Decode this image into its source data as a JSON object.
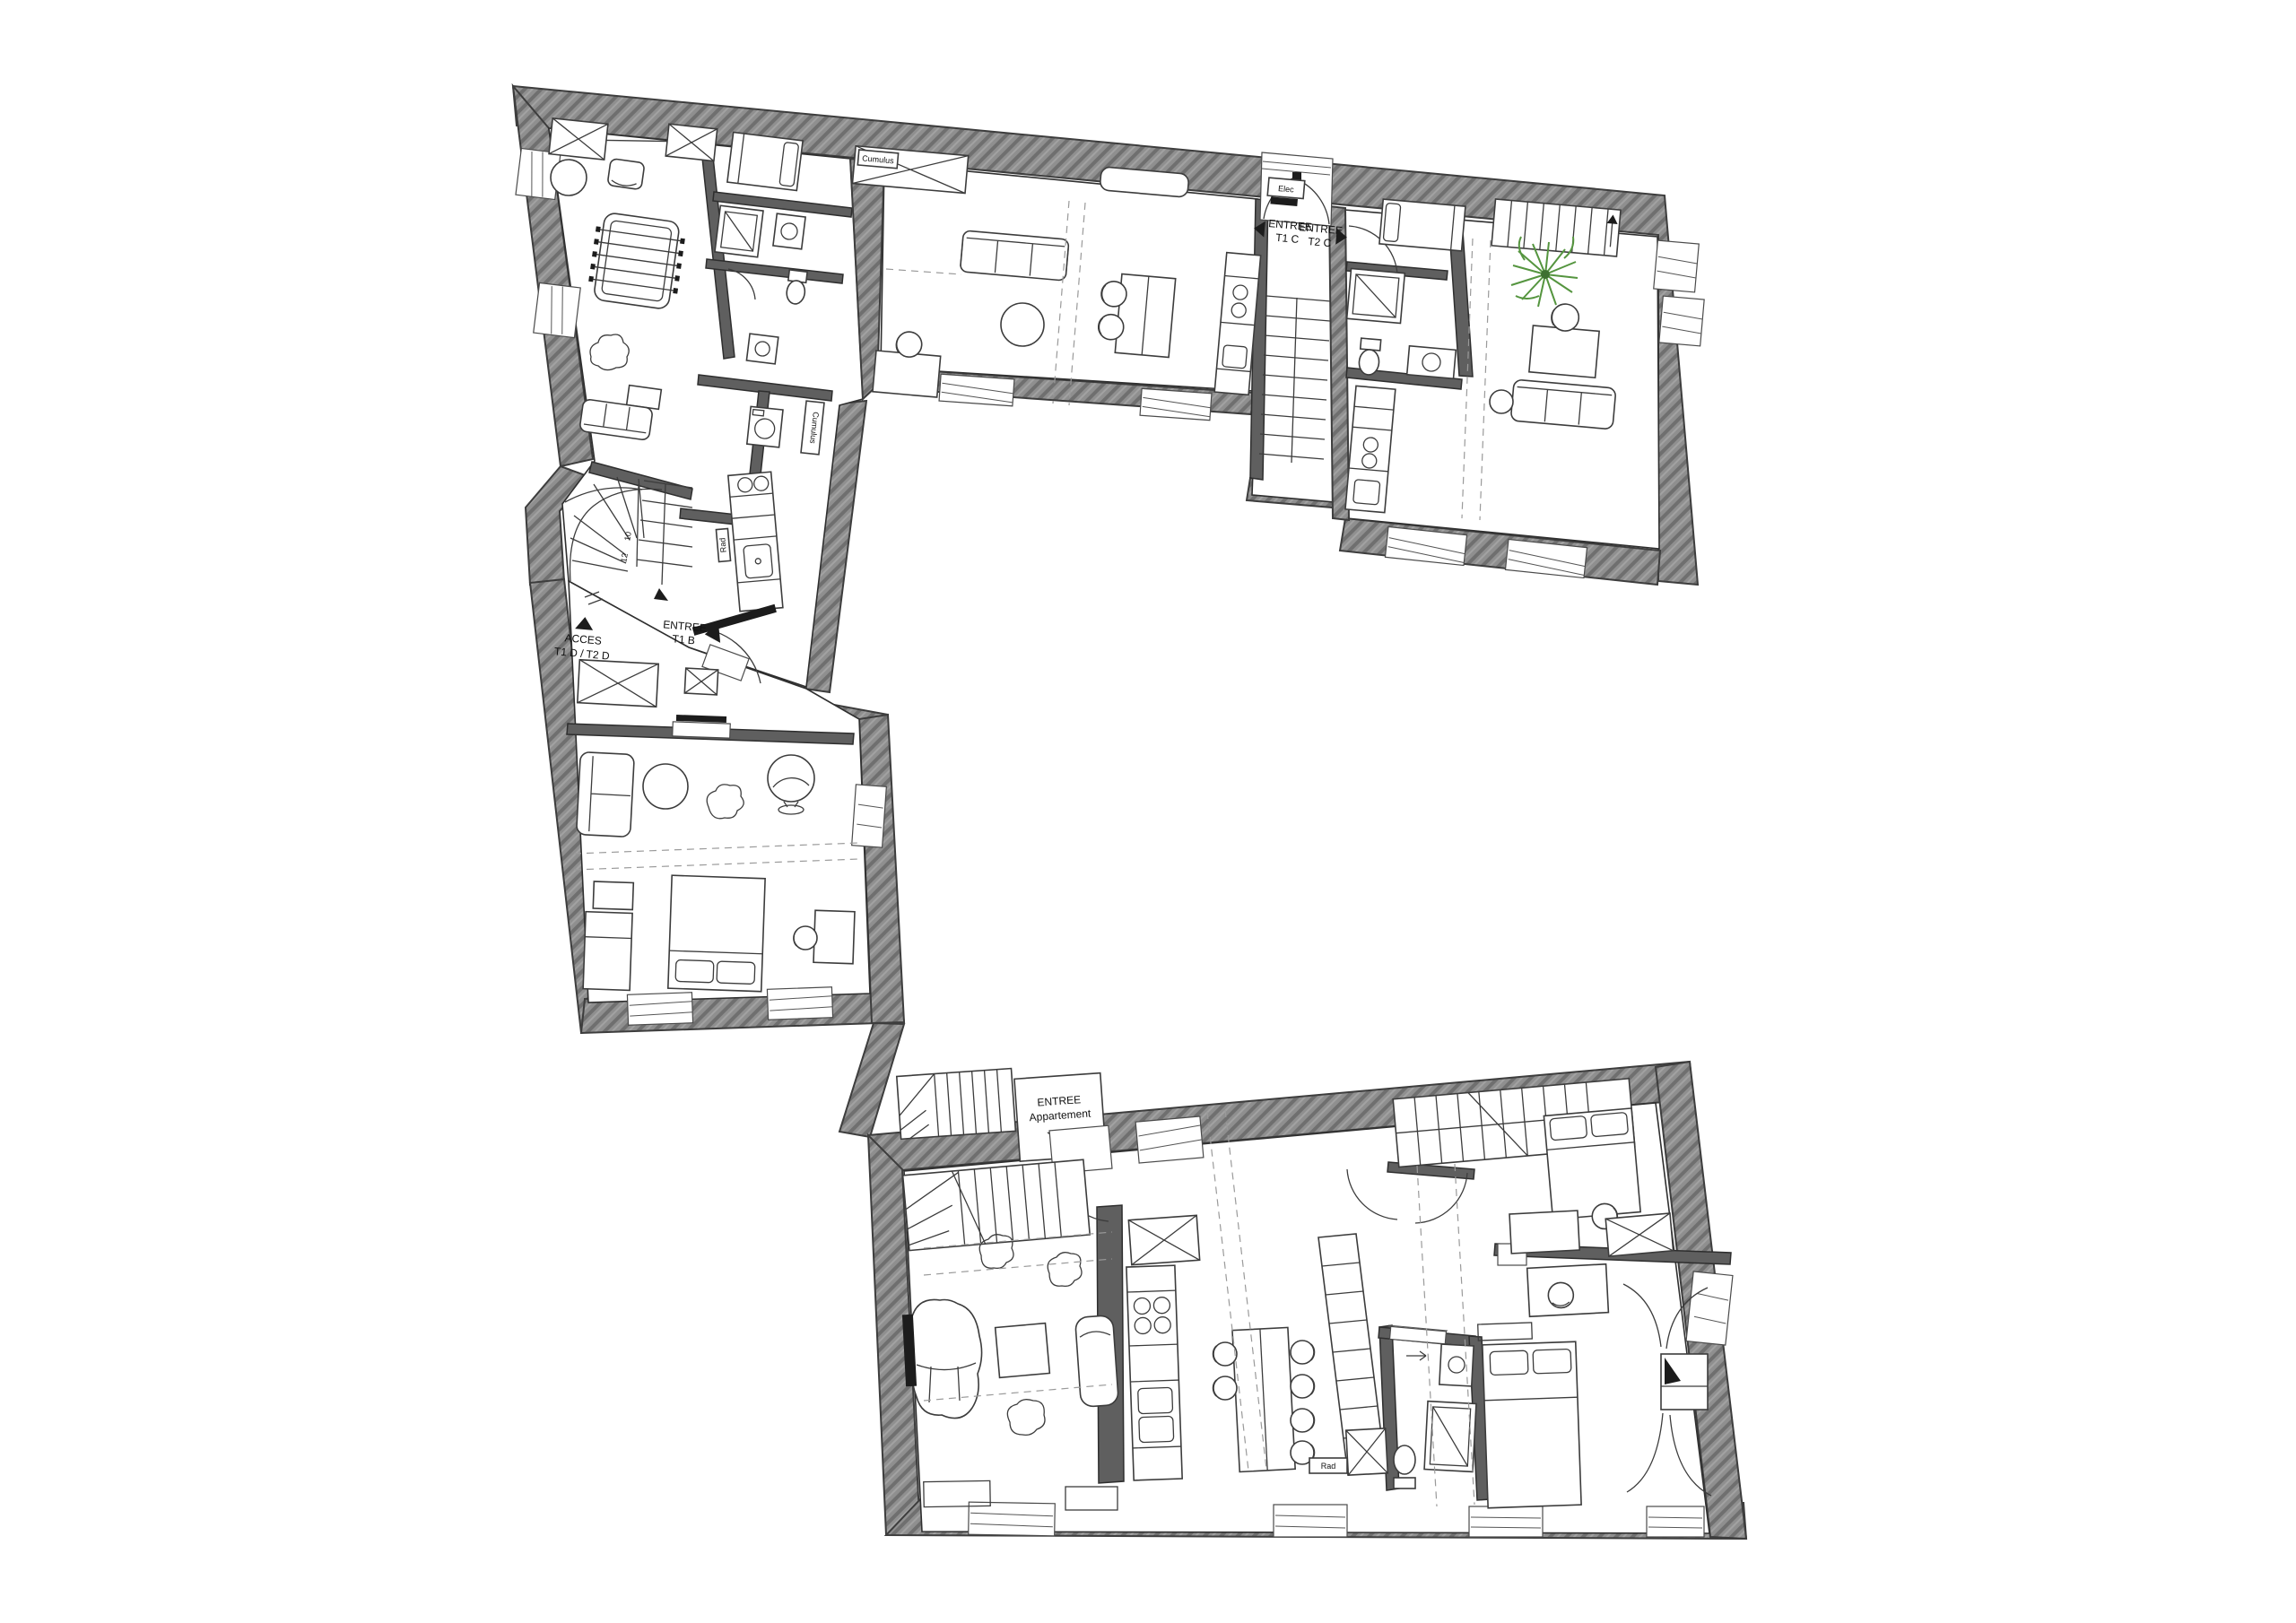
{
  "drawing": {
    "type": "architectural-floor-plan",
    "background": "#ffffff",
    "wall_fill": "#8f8f8f",
    "wall_hatch": "#6f6f6f",
    "line_color": "#2f2f2f",
    "plant_color": "#55953f"
  },
  "labels": {
    "entree_t1c": {
      "line1": "ENTREE",
      "line2": "T1 C"
    },
    "entree_t2c": {
      "line1": "ENTREE",
      "line2": "T2 C"
    },
    "acces_t1d": {
      "line1": "ACCES",
      "line2": "T1 D / T2 D"
    },
    "entree_t1b": {
      "line1": "ENTREE",
      "line2": "T1 B"
    },
    "entree_appartement": {
      "line1": "ENTREE",
      "line2": "Appartement"
    },
    "elec": "Elec",
    "cumulus_t1c": "Cumulus",
    "cumulus_t1b": "Cumulus",
    "rad_t1b": "Rad",
    "rad_appartement": "Rad",
    "stair_step_10": "10",
    "stair_step_12": "12"
  }
}
